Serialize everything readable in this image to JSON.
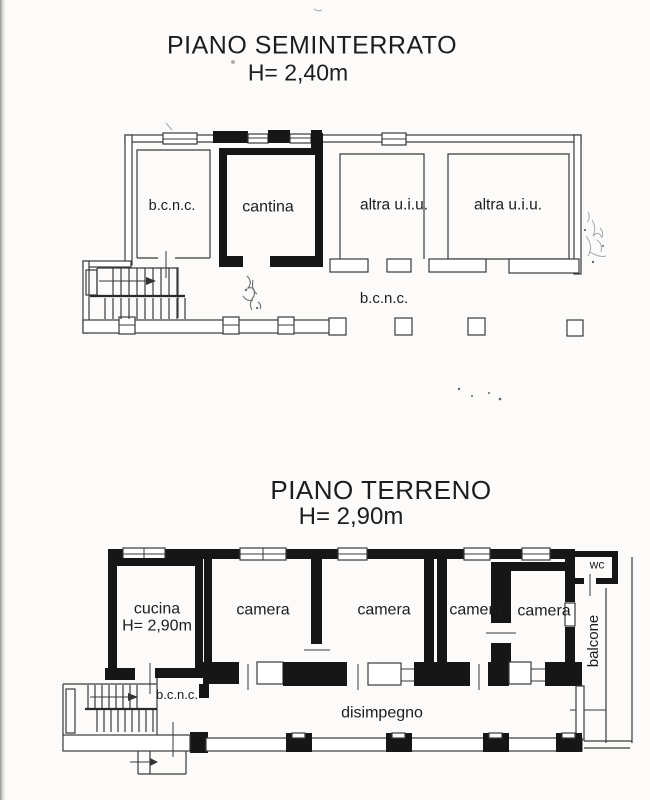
{
  "colors": {
    "paper": "#fcfbf9",
    "ink": "#1d1d1d",
    "wall_bold": "#161616",
    "wall_thin": "#3a3a3a"
  },
  "floors": [
    {
      "id": "seminterrato",
      "title": "PIANO SEMINTERRATO",
      "height_label": "H= 2,40m",
      "rooms": [
        {
          "name": "bcnc-room",
          "label": "b.c.n.c."
        },
        {
          "name": "cantina",
          "label": "cantina"
        },
        {
          "name": "altra-uiu-1",
          "label": "altra u.i.u."
        },
        {
          "name": "altra-uiu-2",
          "label": "altra u.i.u."
        },
        {
          "name": "bcnc-corridor",
          "label": "b.c.n.c."
        }
      ]
    },
    {
      "id": "terreno",
      "title": "PIANO TERRENO",
      "height_label": "H= 2,90m",
      "rooms": [
        {
          "name": "cucina",
          "label": "cucina",
          "sublabel": "H= 2,90m"
        },
        {
          "name": "camera-1",
          "label": "camera"
        },
        {
          "name": "camera-2",
          "label": "camera"
        },
        {
          "name": "camera-3",
          "label": "camera"
        },
        {
          "name": "camera-4",
          "label": "camera"
        },
        {
          "name": "wc",
          "label": "wc"
        },
        {
          "name": "balcone",
          "label": "balcone"
        },
        {
          "name": "bcnc-landing",
          "label": "b.c.n.c."
        },
        {
          "name": "disimpegno",
          "label": "disimpegno"
        }
      ]
    }
  ]
}
